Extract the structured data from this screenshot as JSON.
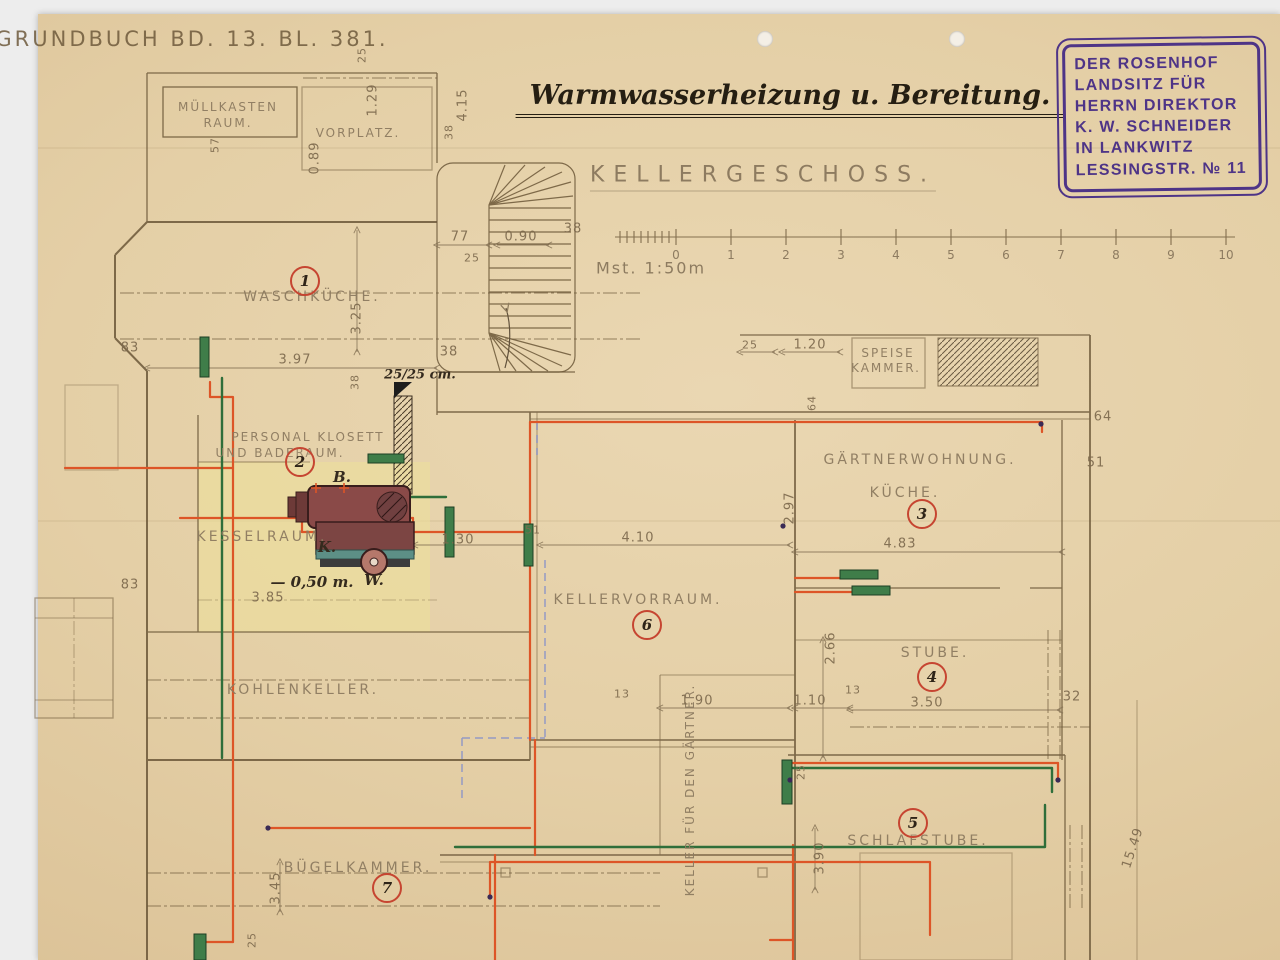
{
  "header": {
    "grundbuch": "GRUNDBUCH BD. 13. BL. 381.",
    "title": "Warmwasserheizung u. Bereitung.",
    "floor_label": "KELLERGESCHOSS.",
    "scale_label": "Mst. 1:50m"
  },
  "stamp": {
    "lines": [
      "DER ROSENHOF",
      "LANDSITZ FÜR",
      "HERRN DIREKTOR",
      "K. W. SCHNEIDER",
      "IN LANKWITZ",
      "LESSINGSTR. № 11"
    ],
    "color": "#4e3487"
  },
  "scale_bar": {
    "ticks": [
      "0",
      "1",
      "2",
      "3",
      "4",
      "5",
      "6",
      "7",
      "8",
      "9",
      "10"
    ]
  },
  "rooms": {
    "muellkasten": {
      "line1": "MÜLLKASTEN",
      "line2": "RAUM."
    },
    "vorplatz": {
      "label": "VORPLATZ."
    },
    "waschkueche": {
      "num": "1",
      "label": "WASCHKÜCHE."
    },
    "klosett": {
      "num": "2",
      "line1": "PERSONAL KLOSETT",
      "line2": "UND BADERAUM."
    },
    "kesselraum": {
      "label": "KESSELRAUM."
    },
    "kohlenkeller": {
      "label": "KOHLENKELLER."
    },
    "buegelkammer": {
      "num": "7",
      "label": "BÜGELKAMMER."
    },
    "gaertnerwohnung": {
      "num": "3",
      "line1": "GÄRTNERWOHNUNG.",
      "line2": "KÜCHE."
    },
    "kellervorraum": {
      "num": "6",
      "label": "KELLERVORRAUM."
    },
    "stube": {
      "num": "4",
      "label": "STUBE."
    },
    "schlafstube": {
      "num": "5",
      "label": "SCHLAFSTUBE."
    },
    "speisekammer": {
      "line1": "SPEISE",
      "line2": "KAMMER."
    },
    "gaertnerkeller": {
      "label": "KELLER FÜR DEN GÄRTNER."
    }
  },
  "equipment": {
    "tank": "B.",
    "kessel": "K.",
    "pump": "W.",
    "depth": "— 0,50 m.",
    "flue": "25/25 cm."
  },
  "dims": [
    "3.97",
    "3.25",
    "38",
    "83",
    "83",
    "3.85",
    "77",
    "0.90",
    "38",
    "25",
    "38",
    "4.15",
    "38",
    "1.29",
    "0.89",
    "57",
    "25",
    "25",
    "1.20",
    "64",
    "2.97",
    "4.83",
    "4.10",
    "1.30",
    "51",
    "64",
    "51",
    "2.66",
    "13",
    "1.90",
    "1.10",
    "13",
    "3.50",
    "32",
    "3.90",
    "25",
    "3.45",
    "15.49",
    "25/25 cm.",
    "25"
  ],
  "colors": {
    "pipe_hot": "#dd5527",
    "pipe_return": "#2f6e3a",
    "radiator": "#3f7d49",
    "marker_red": "#c64531",
    "stamp_purple": "#4e3487",
    "paper": "#e4cfa6"
  }
}
